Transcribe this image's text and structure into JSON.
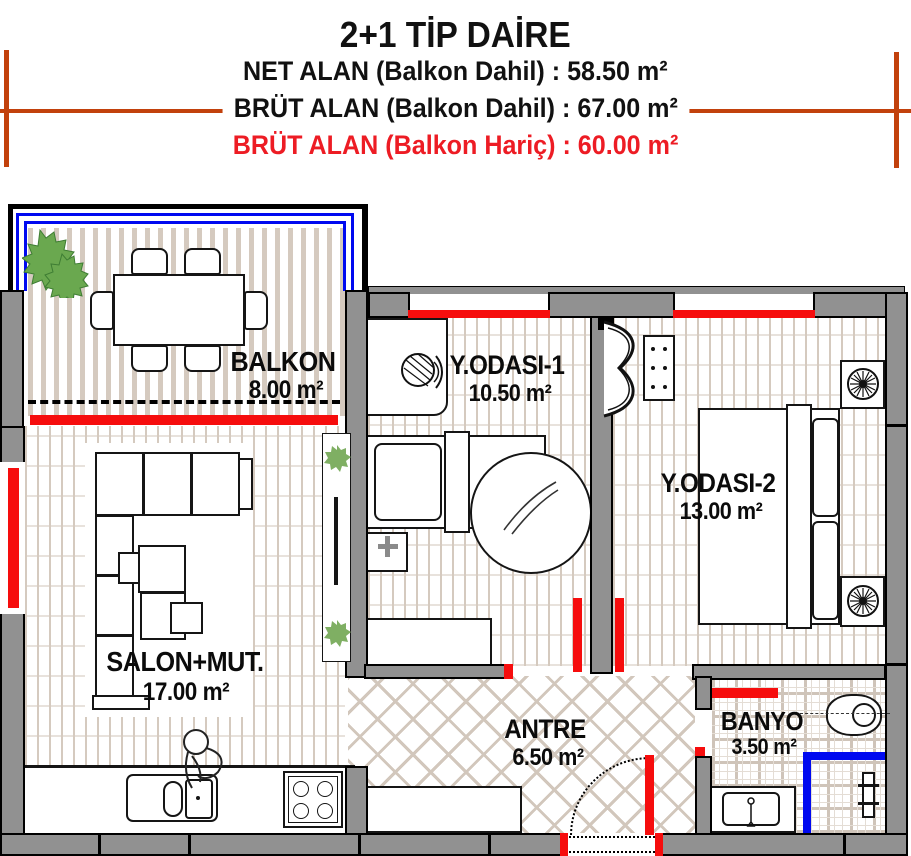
{
  "header": {
    "title": "2+1 TİP DAİRE",
    "net_alan": "NET ALAN (Balkon Dahil) : 58.50 m²",
    "brut_alan_dahil": "BRÜT ALAN (Balkon Dahil) : 67.00 m²",
    "brut_alan_haric": "BRÜT ALAN (Balkon Hariç) : 60.00 m²"
  },
  "rooms": [
    {
      "id": "balkon",
      "name": "BALKON",
      "area": "8.00 m²"
    },
    {
      "id": "yodasi1",
      "name": "Y.ODASI-1",
      "area": "10.50 m²"
    },
    {
      "id": "yodasi2",
      "name": "Y.ODASI-2",
      "area": "13.00 m²"
    },
    {
      "id": "salon",
      "name": "SALON+MUT.",
      "area": "17.00 m²"
    },
    {
      "id": "antre",
      "name": "ANTRE",
      "area": "6.50 m²"
    },
    {
      "id": "banyo",
      "name": "BANYO",
      "area": "3.50 m²"
    }
  ],
  "colors": {
    "wall_gray": "#919191",
    "window_red": "#f60d0d",
    "railing_blue": "#0009f0",
    "title_accent_orange": "#c2410c",
    "haric_text_red": "#ed1c24",
    "floor_beige": "#d5cabf",
    "plant_green": "#6aa84f"
  }
}
